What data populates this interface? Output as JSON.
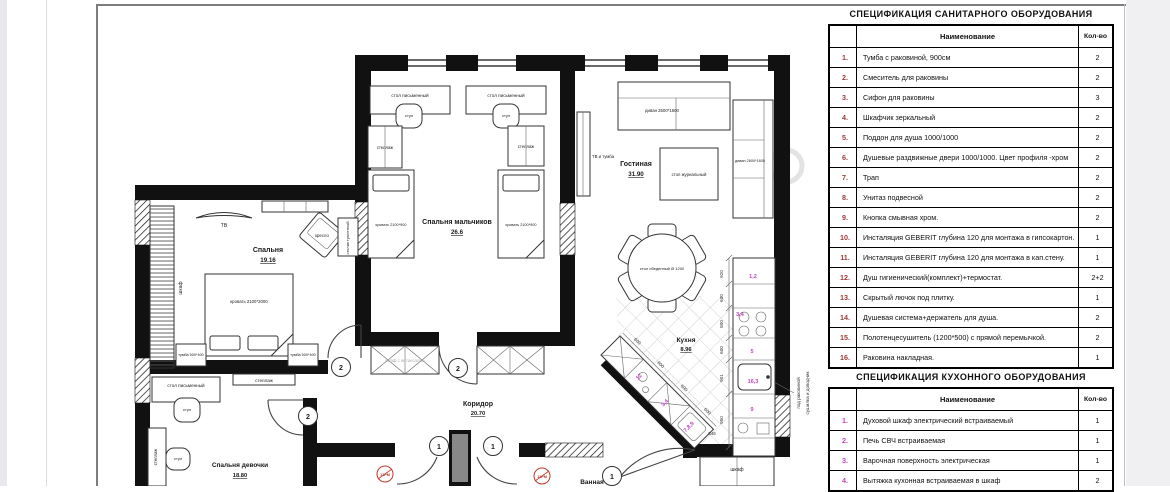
{
  "sanitary_table": {
    "title": "СПЕЦИФИКАЦИЯ САНИТАРНОГО ОБОРУДОВАНИЯ",
    "col_name": "Наименование",
    "col_qty": "Кол-во",
    "rows": [
      {
        "num": "1.",
        "name": "Тумба с раковиной, 900см",
        "qty": "2"
      },
      {
        "num": "2.",
        "name": "Смеситель для раковины",
        "qty": "2"
      },
      {
        "num": "3.",
        "name": "Сифон для раковины",
        "qty": "3"
      },
      {
        "num": "4.",
        "name": "Шкафчик зеркальный",
        "qty": "2"
      },
      {
        "num": "5.",
        "name": "Поддон для душа 1000/1000",
        "qty": "2"
      },
      {
        "num": "6.",
        "name": "Душевые раздвижные двери 1000/1000. Цвет профиля -хром",
        "qty": "2"
      },
      {
        "num": "7.",
        "name": "Трап",
        "qty": "2"
      },
      {
        "num": "8.",
        "name": "Унитаз подвесной",
        "qty": "2"
      },
      {
        "num": "9.",
        "name": "Кнопка смывная хром.",
        "qty": "2"
      },
      {
        "num": "10.",
        "name": "Инсталяция GEBERIT глубина 120 для монтажа в гипсокартон.",
        "qty": "1"
      },
      {
        "num": "11.",
        "name": "Инсталяция GEBERIT глубина 120 для монтажа в кап.стену.",
        "qty": "1"
      },
      {
        "num": "12.",
        "name": "Душ гигиенический(комплект)+термостат.",
        "qty": "2+2"
      },
      {
        "num": "13.",
        "name": "Скрытый лючок под плитку.",
        "qty": "1"
      },
      {
        "num": "14.",
        "name": "Душевая система+держатель для душа.",
        "qty": "2"
      },
      {
        "num": "15.",
        "name": "Полотенцесушитель (1200*500) с прямой перемычкой.",
        "qty": "2"
      },
      {
        "num": "16.",
        "name": "Раковина накладная.",
        "qty": "1"
      }
    ]
  },
  "kitchen_table": {
    "title": "СПЕЦИФИКАЦИЯ КУХОННОГО ОБОРУДОВАНИЯ",
    "col_name": "Наименование",
    "col_qty": "Кол-во",
    "rows": [
      {
        "num": "1.",
        "name": "Духовой шкаф электрический встраиваемый",
        "qty": "1"
      },
      {
        "num": "2.",
        "name": "Печь СВЧ встраиваемая",
        "qty": "1"
      },
      {
        "num": "3.",
        "name": "Варочная поверхность электрическая",
        "qty": "1"
      },
      {
        "num": "4.",
        "name": "Вытяжка кухонная встраиваемая в шкаф",
        "qty": "2"
      }
    ]
  },
  "plan": {
    "rooms": {
      "bedroom": {
        "name": "Спальня",
        "area": "19.16"
      },
      "boys": {
        "name": "Спальня мальчиков",
        "area": "26.6"
      },
      "living": {
        "name": "Гостиная",
        "area": "31.90"
      },
      "kitchen": {
        "name": "Кухня",
        "area": "8.96"
      },
      "corridor": {
        "name": "Коридор",
        "area": "20.70"
      },
      "girl": {
        "name": "Спальня девочки",
        "area": "18.80"
      },
      "bath": {
        "name": "Ванная"
      }
    },
    "furniture": {
      "tv": "ТВ",
      "wardrobe": "шкаф",
      "armchair": "кресло",
      "dressing_table": "столик туалетный",
      "bed_double": "кровать 2100*2000",
      "nightstand": "тумба 500*400",
      "shelf": "стеллаж",
      "desk": "стол письменный",
      "chair": "стул",
      "bed_single": "кровать 2100*900",
      "tv_stand": "ТВ и тумба",
      "sofa_top": "диван 2500*1600",
      "sofa_right": "диван 2600*1600",
      "coffee_table": "стол журнальный",
      "dining_table": "стол обеденный Ø 1200",
      "closet": "шкаф",
      "wardrobe_note": "шкаф с антресолью"
    },
    "notes": {
      "under_sink": "под раковиной",
      "closer": "сушилка и доводчик"
    },
    "dims": {
      "v": [
        "920",
        "600",
        "800",
        "600",
        "901",
        "950"
      ],
      "diag": [
        "600",
        "600",
        "600",
        "600"
      ],
      "corner": "646"
    },
    "door_tags": {
      "d1": "1",
      "d2": "2"
    },
    "red_tag": "12РМ",
    "magenta": {
      "oven_micro": "1,2",
      "hob_hood": "3,4",
      "five": "5",
      "sink": "16,3",
      "nine": "9",
      "twelve": "12",
      "corner": "7,8,9"
    }
  }
}
